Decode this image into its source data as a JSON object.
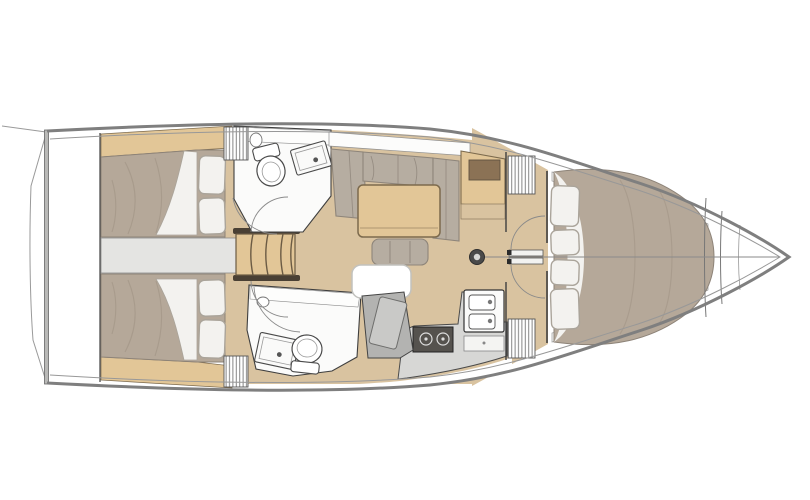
{
  "figure": {
    "type": "floor-plan-diagram",
    "subject": "sailing-yacht-interior-layout",
    "orientation": "bow-right",
    "cabins_visible": 3,
    "heads_visible": 2
  },
  "palette": {
    "hull_outline": "#7f7f7f",
    "inner_line": "#989898",
    "deck": "#ffffff",
    "wall": "#3f3f3f",
    "floor_wood": "#d9c3a0",
    "furniture_wood": "#e2c697",
    "wood_edge": "#7c6a4d",
    "cabinet_panel": "#8b7255",
    "mattress": "#b5a899",
    "mattress_edge": "#8d8378",
    "mattress_shade": "#9d9082",
    "sofa": "#b6ada1",
    "sofa_edge": "#8e857a",
    "linen": "#f3f2ef",
    "linen_edge": "#aaa49a",
    "fixture": "#fbfbfa",
    "fixture_edge": "#4a4a4a",
    "counter": "#d7d7d5",
    "stove_body": "#55524e",
    "console": "#b3b3b1",
    "console_panel": "#c9c9c7",
    "corridor": "#e4e4e2",
    "steps_rail": "#4a4034",
    "hatch_white": "#ffffff",
    "mast_dark": "#4a4a4a",
    "mast_light": "#d8d8d6"
  },
  "rooms": [
    "aft-cabin-port",
    "aft-cabin-starboard",
    "head-port",
    "head-starboard",
    "salon",
    "galley",
    "nav-station",
    "forward-cabin",
    "anchor-locker",
    "transom-platform"
  ],
  "fixtures": [
    "companionway-steps",
    "salon-table",
    "l-sofa",
    "ottoman",
    "floor-hatch",
    "chart-cabinet",
    "double-sink",
    "two-burner-stove",
    "toilet",
    "shower-tray",
    "mast",
    "v-berth",
    "pillows",
    "louvered-lockers",
    "cabin-doors"
  ]
}
